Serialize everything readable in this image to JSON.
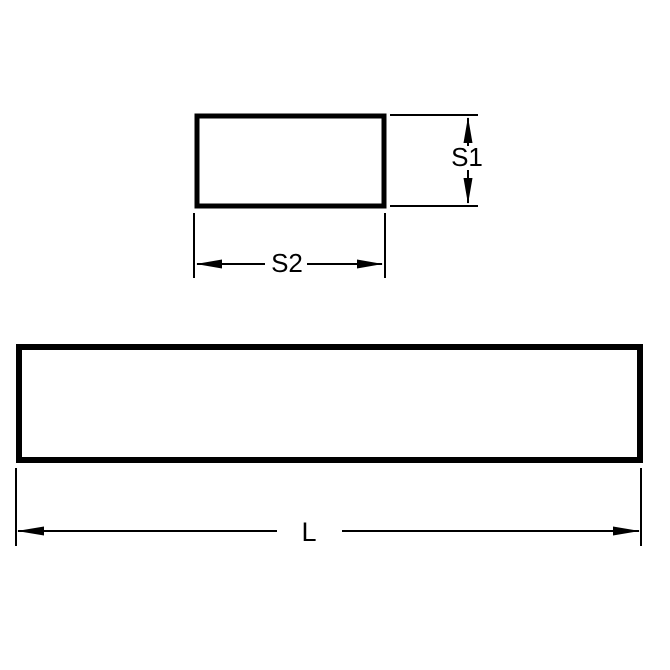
{
  "diagram": {
    "labels": {
      "height": "S1",
      "width": "S2",
      "length": "L"
    },
    "colors": {
      "line": "#000000",
      "background": "#ffffff"
    }
  }
}
